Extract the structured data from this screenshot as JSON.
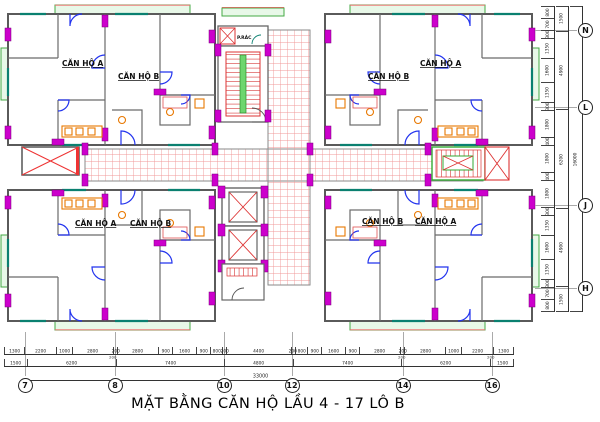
{
  "title": "MẶT BẰNG CĂN HỘ LẦU 4 - 17 LÔ B",
  "plan": {
    "units": {
      "tl": [
        "CĂN HỘ A",
        "CĂN HỘ B"
      ],
      "tr": [
        "CĂN HỘ B",
        "CĂN HỘ A"
      ],
      "bl": [
        "CĂN HỘ A",
        "CĂN HỘ B"
      ],
      "br": [
        "CĂN HỘ B",
        "CĂN HỘ A"
      ]
    },
    "rooms": {
      "trash": "P.RÁC"
    }
  },
  "dims": {
    "bottom": {
      "row1": [
        "1300",
        "2200",
        "1000",
        "2800",
        "200",
        "2800",
        "900",
        "1600",
        "900",
        "800",
        "200",
        "4400",
        "200",
        "800",
        "900",
        "1600",
        "900",
        "2800",
        "200",
        "2800",
        "1000",
        "2200",
        "1300"
      ],
      "row2": [
        "1500",
        "6200",
        "7400",
        "4800",
        "7400",
        "6200",
        "1500"
      ],
      "wall": [
        "200",
        "200",
        "200"
      ],
      "total": "33000"
    },
    "right": {
      "col1": [
        "800",
        "700",
        "300",
        "1350",
        "1600",
        "1350",
        "300",
        "1800",
        "400",
        "1800",
        "400",
        "1800",
        "300",
        "1350",
        "1600",
        "1350",
        "300",
        "700",
        "800"
      ],
      "col2": [
        "1500",
        "4900",
        "6200",
        "4900",
        "1500"
      ],
      "total": "16000"
    }
  },
  "grid": {
    "bottom": [
      "7",
      "8",
      "10",
      "12",
      "14",
      "16"
    ],
    "right": [
      "N",
      "L",
      "J",
      "H"
    ]
  },
  "colors": {
    "wall": "#5a5a5a",
    "column": "#cc00cc",
    "door": "#2233ee",
    "fixture": "#e87800",
    "tile_hatch": "#f09898",
    "balcony_green": "#44aa44",
    "window_teal": "#0a8070",
    "accent_red": "#dd3333",
    "stair_rail_green": "#6ed66e"
  }
}
